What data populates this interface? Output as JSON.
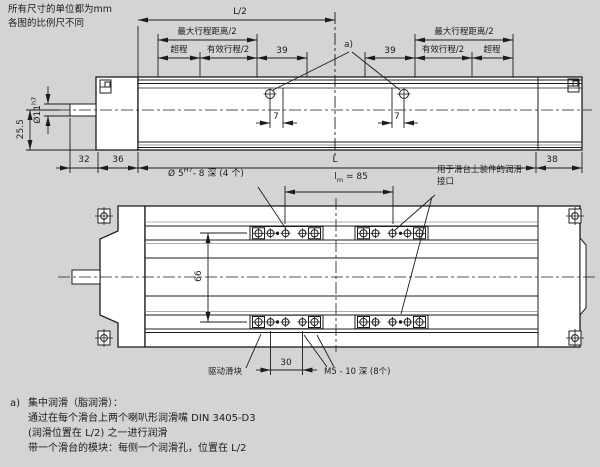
{
  "page": {
    "note_line1": "所有尺寸的单位都为mm",
    "note_line2": "各图的比例尺不同"
  },
  "side_view": {
    "dim_l_half": "L/2",
    "dim_max_travel_left": "最大行程距离/2",
    "dim_max_travel_right": "最大行程距离/2",
    "dim_overtravel_left": "超程",
    "dim_overtravel_right": "超程",
    "dim_effective_left": "有效行程/2",
    "dim_effective_right": "有效行程/2",
    "dim_39_left": "39",
    "dim_39_right": "39",
    "callout_a": "a)",
    "dim_7_left": "7",
    "dim_7_right": "7",
    "dim_shaft_dia": "Ø11",
    "dim_shaft_tol": "h7",
    "dim_height": "25.5",
    "dim_32": "32",
    "dim_36": "36",
    "dim_L": "L",
    "dim_38": "38"
  },
  "plan_view": {
    "label_dowel_prefix": "Ø 5",
    "label_dowel_sup": "H7",
    "label_dowel_suffix": "- 8 深 (4 个)",
    "label_lm_base": "l",
    "label_lm_sub": "m",
    "label_lm_value": "= 85",
    "label_lube_line1": "用于滑台上装件的润滑",
    "label_lube_line2": "接口",
    "dim_66": "66",
    "dim_30": "30",
    "label_drive_block": "驱动滑块",
    "label_m5": "M5 - 10 深 (8个)"
  },
  "footnote": {
    "marker": "a)",
    "line1": "集中润滑（脂润滑）：",
    "line2": "通过在每个滑台上两个喇叭形润滑嘴 DIN 3405-D3",
    "line3": "(润滑位置在 L/2) 之一进行润滑",
    "line4": "带一个滑台的模块：每侧一个润滑孔，位置在 L/2"
  },
  "colors": {
    "background": "#d4d4d4",
    "line": "#1c1c1c",
    "surface": "#ffffff",
    "gray_line": "#909090"
  }
}
